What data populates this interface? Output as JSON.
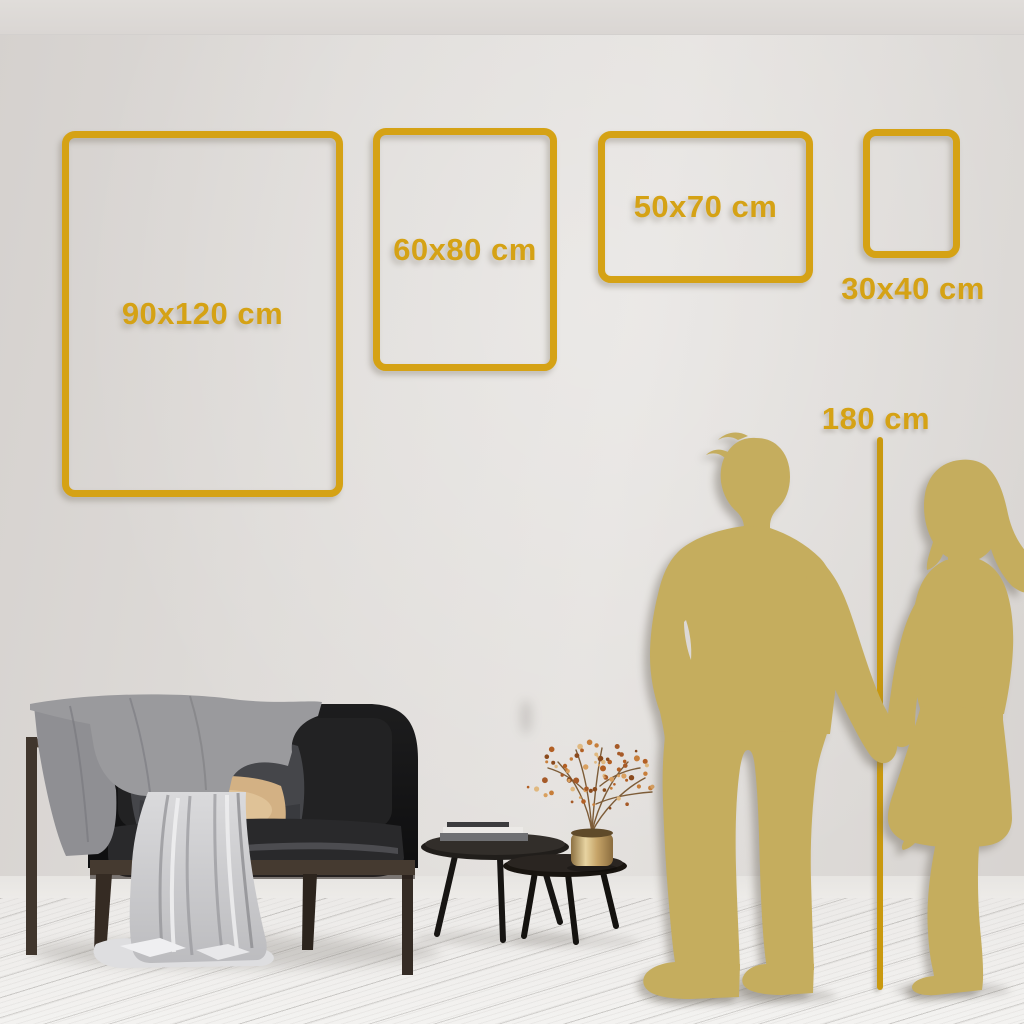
{
  "size_guide": {
    "frames": [
      {
        "id": "90x120",
        "label": "90x120 cm"
      },
      {
        "id": "60x80",
        "label": "60x80 cm"
      },
      {
        "id": "50x70",
        "label": "50x70 cm"
      },
      {
        "id": "30x40",
        "label": "30x40 cm"
      }
    ],
    "height_reference": {
      "label": "180 cm"
    }
  },
  "colors": {
    "accent_gold": "#D5A215",
    "ruler_gold": "#C9990F",
    "silhouette_gold": "#C5AD5E",
    "wall": "#DFDBD8",
    "floor": "#F1F0EE"
  },
  "scene_objects": [
    "sofa-with-throw-blanket",
    "white-drape-sheet",
    "nesting-coffee-tables-with-books",
    "brass-vase-with-berry-branches",
    "couple-holding-hands-silhouette",
    "height-ruler"
  ]
}
